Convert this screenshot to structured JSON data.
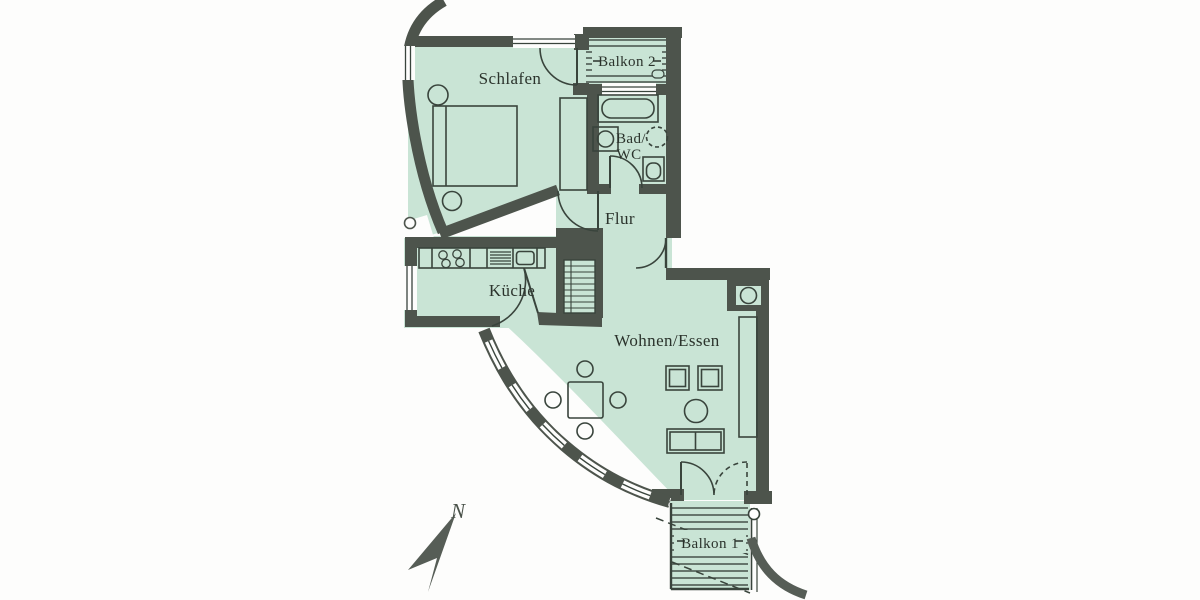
{
  "plan": {
    "rooms": {
      "bedroom": {
        "label": "Schlafen"
      },
      "balcony2": {
        "label": "Balkon 2"
      },
      "bathroom": {
        "label_line1": "Bad/",
        "label_line2": "WC"
      },
      "hallway": {
        "label": "Flur"
      },
      "kitchen": {
        "label": "Küche"
      },
      "living_dining": {
        "label": "Wohnen/Essen"
      },
      "balcony1": {
        "label": "Balkon 1"
      }
    },
    "compass": {
      "north_label": "N"
    },
    "colors": {
      "floor_fill": "#c9e4d5",
      "wall": "#4d544c",
      "background": "#ffffff"
    }
  }
}
